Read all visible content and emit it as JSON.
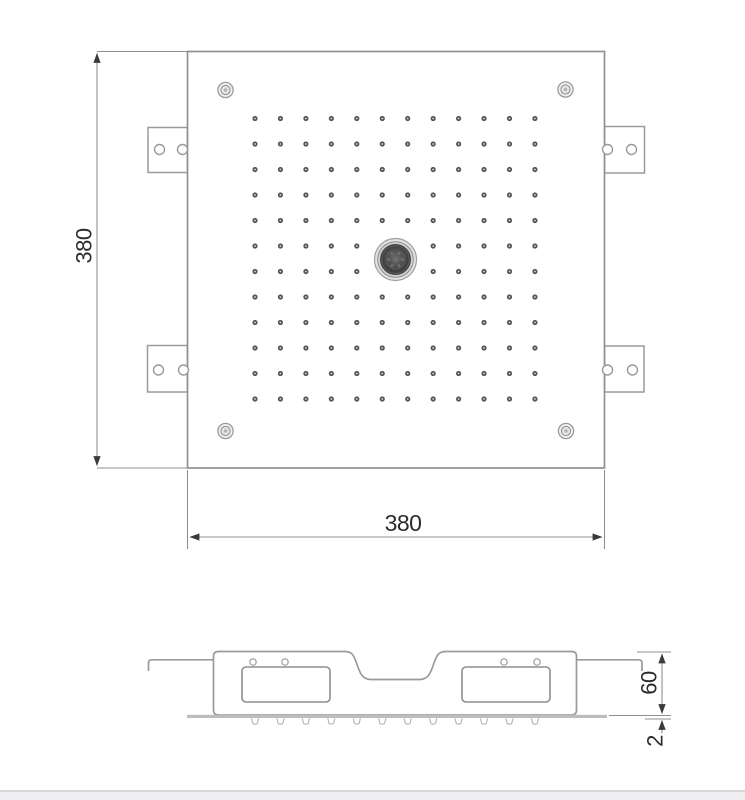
{
  "drawing": {
    "dimensions": {
      "height": "380",
      "width": "380",
      "depth": "60",
      "plate_thickness": "2"
    },
    "top_view": {
      "nozzle_grid": {
        "rows": 12,
        "cols": 12,
        "origin_x": 255,
        "origin_y": 118.5,
        "step_x": 25.45,
        "step_y": 25.5
      },
      "corner_screw_count": 4,
      "mounting_tab_count": 4
    },
    "side_view": {
      "nozzle_row": {
        "count": 12,
        "origin_x": 255,
        "y": 718,
        "step_x": 25.45
      },
      "chamber_count": 2
    },
    "colors": {
      "outline": "#979797",
      "dim_line": "#8f8f8f",
      "arrow": "#3a3a3a",
      "text": "#2b2b2b",
      "nozzle_dot_dark": "#565656",
      "nozzle_dot_light": "#d9d9d9",
      "center_unit_dark": "#4d4d4d",
      "plate_gray": "#bdbdbd",
      "side_nozzle": "#b2b2b2",
      "bottom_bar": "#efeff1"
    }
  }
}
